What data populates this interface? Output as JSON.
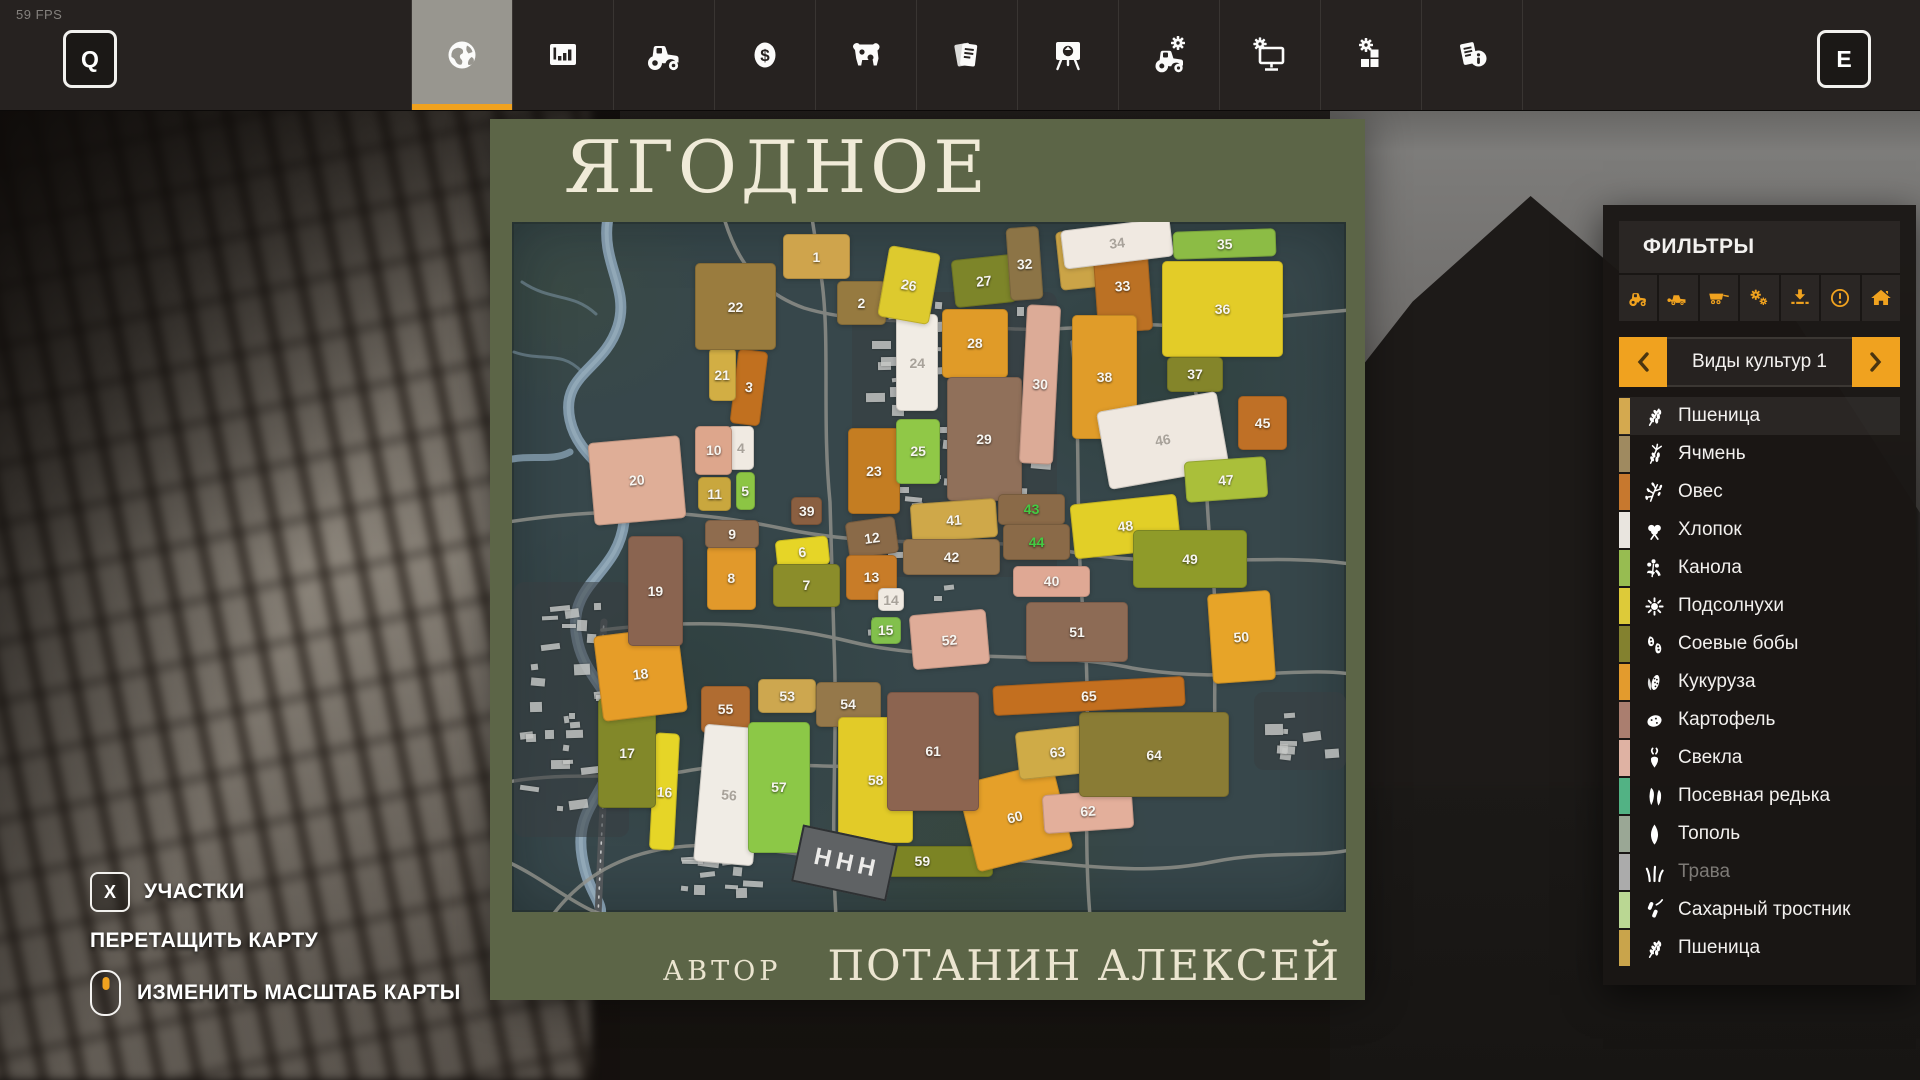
{
  "hud": {
    "fps": "59 FPS",
    "left_key": "Q",
    "right_key": "E"
  },
  "topbar": {
    "tabs": [
      {
        "name": "map",
        "icon": "globe",
        "active": true
      },
      {
        "name": "statistics",
        "icon": "chart",
        "active": false
      },
      {
        "name": "vehicles",
        "icon": "tractor",
        "active": false
      },
      {
        "name": "finances",
        "icon": "dollar",
        "active": false
      },
      {
        "name": "animals",
        "icon": "cow",
        "active": false
      },
      {
        "name": "contracts",
        "icon": "papers",
        "active": false
      },
      {
        "name": "prices",
        "icon": "easel",
        "active": false
      },
      {
        "name": "helpers",
        "icon": "tractor-gear",
        "active": false
      },
      {
        "name": "machines",
        "icon": "monitor-gear",
        "active": false
      },
      {
        "name": "production",
        "icon": "blocks-gear",
        "active": false
      },
      {
        "name": "help",
        "icon": "paper-info",
        "active": false
      }
    ]
  },
  "map": {
    "title": "ЯГОДНОЕ",
    "author_label": "АВТОР",
    "author_name": "ПОТАНИН АЛЕКСЕЙ",
    "shed_label": "ННН",
    "fields": [
      {
        "n": "1",
        "x": 32.5,
        "y": 1.8,
        "w": 8.0,
        "h": 6.5,
        "r": 0,
        "c": "#cfa44c"
      },
      {
        "n": "2",
        "x": 39.0,
        "y": 8.5,
        "w": 5.8,
        "h": 6.5,
        "r": 0,
        "c": "#967a40"
      },
      {
        "n": "3",
        "x": 26.6,
        "y": 18.5,
        "w": 3.6,
        "h": 10.8,
        "r": 7,
        "c": "#c1701f"
      },
      {
        "n": "4",
        "x": 25.9,
        "y": 29.5,
        "w": 3.1,
        "h": 6.4,
        "r": 0,
        "c": "#f0eae2",
        "t": "dim"
      },
      {
        "n": "5",
        "x": 26.8,
        "y": 36.2,
        "w": 2.3,
        "h": 5.6,
        "r": 0,
        "c": "#8cc544"
      },
      {
        "n": "6",
        "x": 31.7,
        "y": 45.8,
        "w": 6.3,
        "h": 4.2,
        "r": -6,
        "c": "#e6d527"
      },
      {
        "n": "7",
        "x": 31.3,
        "y": 49.5,
        "w": 8.0,
        "h": 6.3,
        "r": 0,
        "c": "#8b8d2a"
      },
      {
        "n": "8",
        "x": 23.4,
        "y": 47.0,
        "w": 5.8,
        "h": 9.2,
        "r": 0,
        "c": "#e1992b"
      },
      {
        "n": "9",
        "x": 23.2,
        "y": 43.2,
        "w": 6.4,
        "h": 4.0,
        "r": 0,
        "c": "#8f6c4e"
      },
      {
        "n": "10",
        "x": 22.0,
        "y": 29.6,
        "w": 4.4,
        "h": 7.0,
        "r": 0,
        "c": "#dda68c"
      },
      {
        "n": "11",
        "x": 22.3,
        "y": 36.9,
        "w": 4.0,
        "h": 5.0,
        "r": 0,
        "c": "#c9a73e"
      },
      {
        "n": "12",
        "x": 40.2,
        "y": 43.0,
        "w": 6.0,
        "h": 5.4,
        "r": -8,
        "c": "#8a6a48"
      },
      {
        "n": "13",
        "x": 40.0,
        "y": 48.2,
        "w": 6.2,
        "h": 6.6,
        "r": 0,
        "c": "#c87c28"
      },
      {
        "n": "14",
        "x": 43.9,
        "y": 53.1,
        "w": 3.1,
        "h": 3.3,
        "r": 0,
        "c": "#f0eae2",
        "t": "dim"
      },
      {
        "n": "15",
        "x": 43.0,
        "y": 57.2,
        "w": 3.6,
        "h": 4.0,
        "r": 0,
        "c": "#82c04c"
      },
      {
        "n": "16",
        "x": 16.8,
        "y": 74.0,
        "w": 3.0,
        "h": 17.0,
        "r": 3,
        "c": "#e6d527"
      },
      {
        "n": "17",
        "x": 10.3,
        "y": 69.0,
        "w": 7.0,
        "h": 16.0,
        "r": 0,
        "c": "#828829"
      },
      {
        "n": "18",
        "x": 10.3,
        "y": 59.3,
        "w": 10.2,
        "h": 12.5,
        "r": -7,
        "c": "#e69d28"
      },
      {
        "n": "19",
        "x": 13.9,
        "y": 45.5,
        "w": 6.6,
        "h": 16.0,
        "r": 0,
        "c": "#8a6450"
      },
      {
        "n": "20",
        "x": 9.5,
        "y": 31.4,
        "w": 11.0,
        "h": 12.0,
        "r": -5,
        "c": "#dfae97"
      },
      {
        "n": "21",
        "x": 23.6,
        "y": 18.3,
        "w": 3.2,
        "h": 7.7,
        "r": 0,
        "c": "#d2ae44"
      },
      {
        "n": "22",
        "x": 22.0,
        "y": 6.0,
        "w": 9.6,
        "h": 12.5,
        "r": 0,
        "c": "#9a7c3e"
      },
      {
        "n": "23",
        "x": 40.3,
        "y": 29.8,
        "w": 6.2,
        "h": 12.5,
        "r": 0,
        "c": "#c47d22"
      },
      {
        "n": "24",
        "x": 46.1,
        "y": 13.4,
        "w": 5.0,
        "h": 14.0,
        "r": 0,
        "c": "#f1ece4",
        "t": "dim"
      },
      {
        "n": "25",
        "x": 46.1,
        "y": 28.5,
        "w": 5.2,
        "h": 9.5,
        "r": 0,
        "c": "#90c847"
      },
      {
        "n": "26",
        "x": 44.5,
        "y": 3.9,
        "w": 6.2,
        "h": 10.5,
        "r": 10,
        "c": "#ddca2e"
      },
      {
        "n": "27",
        "x": 52.9,
        "y": 5.0,
        "w": 7.4,
        "h": 7.0,
        "r": -6,
        "c": "#7d8529"
      },
      {
        "n": "28",
        "x": 51.5,
        "y": 12.6,
        "w": 8.0,
        "h": 10.0,
        "r": 0,
        "c": "#e09b28"
      },
      {
        "n": "29",
        "x": 52.1,
        "y": 22.4,
        "w": 9.0,
        "h": 18.0,
        "r": 0,
        "c": "#90705a"
      },
      {
        "n": "30",
        "x": 61.3,
        "y": 12.1,
        "w": 4.1,
        "h": 23.0,
        "r": 3,
        "c": "#dcab97"
      },
      {
        "n": "31",
        "x": 65.5,
        "y": 1.2,
        "w": 4.5,
        "h": 8.6,
        "r": -6,
        "c": "#cba447"
      },
      {
        "n": "32",
        "x": 59.5,
        "y": 0.7,
        "w": 4.0,
        "h": 10.6,
        "r": -4,
        "c": "#8c7446"
      },
      {
        "n": "33",
        "x": 69.9,
        "y": 2.4,
        "w": 6.6,
        "h": 13.5,
        "r": -4,
        "c": "#bb7124"
      },
      {
        "n": "34",
        "x": 65.9,
        "y": 0.3,
        "w": 13.2,
        "h": 5.6,
        "r": -7,
        "c": "#f0e9e1",
        "t": "dim"
      },
      {
        "n": "35",
        "x": 79.3,
        "y": 1.2,
        "w": 12.4,
        "h": 4.0,
        "r": -2,
        "c": "#8cbc45"
      },
      {
        "n": "36",
        "x": 77.9,
        "y": 5.6,
        "w": 14.6,
        "h": 14.0,
        "r": 0,
        "c": "#e3cc28"
      },
      {
        "n": "37",
        "x": 78.5,
        "y": 19.5,
        "w": 6.8,
        "h": 5.2,
        "r": 0,
        "c": "#84852a"
      },
      {
        "n": "38",
        "x": 67.1,
        "y": 13.5,
        "w": 7.9,
        "h": 18.0,
        "r": 0,
        "c": "#e09c29"
      },
      {
        "n": "39",
        "x": 33.5,
        "y": 39.8,
        "w": 3.7,
        "h": 4.1,
        "r": 0,
        "c": "#8a5f41"
      },
      {
        "n": "40",
        "x": 60.1,
        "y": 49.8,
        "w": 9.2,
        "h": 4.5,
        "r": 0,
        "c": "#dfa894"
      },
      {
        "n": "41",
        "x": 47.9,
        "y": 40.5,
        "w": 10.3,
        "h": 5.6,
        "r": -4,
        "c": "#cfa849"
      },
      {
        "n": "42",
        "x": 46.9,
        "y": 45.9,
        "w": 11.6,
        "h": 5.3,
        "r": 0,
        "c": "#97764f"
      },
      {
        "n": "43",
        "x": 58.3,
        "y": 39.4,
        "w": 8.0,
        "h": 4.5,
        "r": 0,
        "c": "#8a6a48",
        "t": "green"
      },
      {
        "n": "44",
        "x": 58.9,
        "y": 43.7,
        "w": 8.0,
        "h": 5.3,
        "r": 0,
        "c": "#8a6a48",
        "t": "green"
      },
      {
        "n": "45",
        "x": 87.1,
        "y": 25.2,
        "w": 5.8,
        "h": 7.9,
        "r": 0,
        "c": "#bf7026"
      },
      {
        "n": "46",
        "x": 70.7,
        "y": 26.0,
        "w": 14.6,
        "h": 11.4,
        "r": -10,
        "c": "#efe8e0",
        "t": "dim"
      },
      {
        "n": "47",
        "x": 80.7,
        "y": 34.3,
        "w": 9.8,
        "h": 6.0,
        "r": -4,
        "c": "#aabf3a"
      },
      {
        "n": "48",
        "x": 67.1,
        "y": 40.1,
        "w": 12.8,
        "h": 7.9,
        "r": -6,
        "c": "#e2cf27"
      },
      {
        "n": "49",
        "x": 74.5,
        "y": 44.7,
        "w": 13.6,
        "h": 8.3,
        "r": 0,
        "c": "#8f9b29"
      },
      {
        "n": "50",
        "x": 83.7,
        "y": 53.6,
        "w": 7.5,
        "h": 13.1,
        "r": -4,
        "c": "#e7a428"
      },
      {
        "n": "51",
        "x": 61.6,
        "y": 55.0,
        "w": 12.3,
        "h": 8.8,
        "r": 0,
        "c": "#8d6b55"
      },
      {
        "n": "52",
        "x": 47.8,
        "y": 56.5,
        "w": 9.2,
        "h": 8.0,
        "r": -5,
        "c": "#dfac98"
      },
      {
        "n": "53",
        "x": 29.5,
        "y": 66.2,
        "w": 7.0,
        "h": 5.0,
        "r": 0,
        "c": "#cda74f"
      },
      {
        "n": "54",
        "x": 36.4,
        "y": 66.6,
        "w": 7.8,
        "h": 6.6,
        "r": 0,
        "c": "#95784a"
      },
      {
        "n": "55",
        "x": 22.7,
        "y": 67.2,
        "w": 5.8,
        "h": 6.9,
        "r": 0,
        "c": "#b06c31"
      },
      {
        "n": "56",
        "x": 22.4,
        "y": 73.0,
        "w": 7.2,
        "h": 20.0,
        "r": 5,
        "c": "#f0ece5",
        "t": "dim"
      },
      {
        "n": "57",
        "x": 28.3,
        "y": 72.4,
        "w": 7.4,
        "h": 19.0,
        "r": 0,
        "c": "#8cc847"
      },
      {
        "n": "58",
        "x": 39.1,
        "y": 71.7,
        "w": 9.0,
        "h": 18.3,
        "r": 0,
        "c": "#e2cb28"
      },
      {
        "n": "59",
        "x": 40.7,
        "y": 90.4,
        "w": 17.0,
        "h": 4.5,
        "r": 0,
        "c": "#7c8424"
      },
      {
        "n": "60",
        "x": 54.4,
        "y": 79.7,
        "w": 11.7,
        "h": 13.0,
        "r": -14,
        "c": "#e5a029"
      },
      {
        "n": "61",
        "x": 45.0,
        "y": 68.1,
        "w": 11.0,
        "h": 17.2,
        "r": 0,
        "c": "#8c6450"
      },
      {
        "n": "62",
        "x": 63.7,
        "y": 82.6,
        "w": 10.8,
        "h": 5.6,
        "r": -4,
        "c": "#e3af9b"
      },
      {
        "n": "63",
        "x": 60.5,
        "y": 73.4,
        "w": 9.7,
        "h": 7.0,
        "r": -6,
        "c": "#cfab47"
      },
      {
        "n": "64",
        "x": 68.0,
        "y": 71.0,
        "w": 18.0,
        "h": 12.4,
        "r": 0,
        "c": "#8a7c35"
      },
      {
        "n": "65",
        "x": 57.7,
        "y": 66.5,
        "w": 23.0,
        "h": 4.3,
        "r": -3,
        "c": "#c36f1f"
      }
    ]
  },
  "hints": {
    "plots_key": "X",
    "plots_label": "УЧАСТКИ",
    "drag_label": "ПЕРЕТАЩИТЬ КАРТУ",
    "zoom_label": "ИЗМЕНИТЬ МАСШТАБ КАРТЫ"
  },
  "filters": {
    "title": "ФИЛЬТРЫ",
    "accent_color": "#f0a21f",
    "tools": [
      "tractor",
      "harvester",
      "trailer",
      "gears",
      "download",
      "warning",
      "home"
    ],
    "category": "Виды культур 1",
    "crops": [
      {
        "label": "Пшеница",
        "color": "#d4a94f",
        "icon": "wheat",
        "active": true
      },
      {
        "label": "Ячмень",
        "color": "#9f8a60",
        "icon": "barley"
      },
      {
        "label": "Овес",
        "color": "#c7782e",
        "icon": "oats"
      },
      {
        "label": "Хлопок",
        "color": "#e9e5df",
        "icon": "cotton"
      },
      {
        "label": "Канола",
        "color": "#97bc51",
        "icon": "canola"
      },
      {
        "label": "Подсолнухи",
        "color": "#ddca39",
        "icon": "sunflower"
      },
      {
        "label": "Соевые бобы",
        "color": "#83812f",
        "icon": "soybean"
      },
      {
        "label": "Кукуруза",
        "color": "#e39b2d",
        "icon": "corn"
      },
      {
        "label": "Картофель",
        "color": "#aa7e6f",
        "icon": "potato"
      },
      {
        "label": "Свекла",
        "color": "#dfb2a3",
        "icon": "beet"
      },
      {
        "label": "Посевная редька",
        "color": "#52b284",
        "icon": "radish"
      },
      {
        "label": "Тополь",
        "color": "#9aa795",
        "icon": "poplar"
      },
      {
        "label": "Трава",
        "color": "#ababab",
        "icon": "grass",
        "dim": true
      },
      {
        "label": "Сахарный тростник",
        "color": "#bad793",
        "icon": "sugarcane"
      },
      {
        "label": "Пшеница",
        "color": "#c9a44b",
        "icon": "wheat"
      }
    ]
  }
}
